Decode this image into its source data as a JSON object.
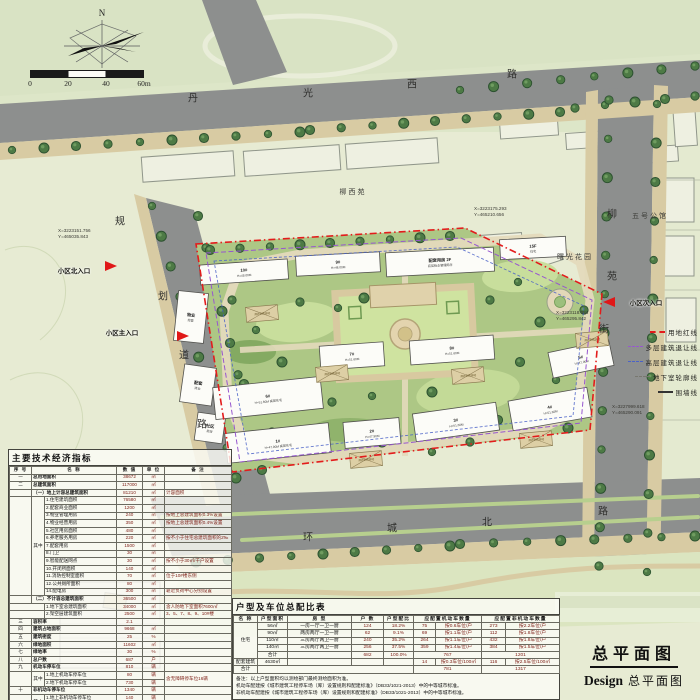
{
  "compass": {
    "north_label": "N"
  },
  "scale_bar": {
    "ticks": [
      "0",
      "20",
      "40",
      "60m"
    ]
  },
  "title_block": {
    "main": "总平面图",
    "sub_en": "Design",
    "sub_cn": "总平面图"
  },
  "legend": {
    "items": [
      {
        "label": "用地红线",
        "style": "red"
      },
      {
        "label": "多层建筑退让线",
        "style": "purple"
      },
      {
        "label": "高层建筑退让线",
        "style": "blue"
      },
      {
        "label": "地下室轮廓线",
        "style": "gray"
      },
      {
        "label": "围墙线",
        "style": "solid"
      }
    ]
  },
  "colors": {
    "boundary_red": "#e31c1c",
    "setback_purple": "#9757cf",
    "setback_blue": "#4a62c8",
    "road_gray": "#8d8f8e",
    "site_green": "#adc785",
    "value_text": "#7d1d15"
  },
  "plan": {
    "road_names": [
      {
        "name": "丹光西路",
        "chars": [
          {
            "c": "丹",
            "x": 193,
            "y": 97
          },
          {
            "c": "光",
            "x": 308,
            "y": 92
          },
          {
            "c": "西",
            "x": 412,
            "y": 83
          },
          {
            "c": "路",
            "x": 512,
            "y": 73
          }
        ]
      },
      {
        "name": "环城北路",
        "chars": [
          {
            "c": "环",
            "x": 308,
            "y": 536
          },
          {
            "c": "城",
            "x": 392,
            "y": 527
          },
          {
            "c": "北",
            "x": 487,
            "y": 521
          },
          {
            "c": "路",
            "x": 603,
            "y": 510
          }
        ]
      },
      {
        "name": "规划道路",
        "chars": [
          {
            "c": "规",
            "x": 120,
            "y": 220
          },
          {
            "c": "划",
            "x": 163,
            "y": 295
          },
          {
            "c": "道",
            "x": 184,
            "y": 354
          },
          {
            "c": "路",
            "x": 202,
            "y": 423
          }
        ]
      },
      {
        "name": "柳苑街",
        "chars": [
          {
            "c": "柳",
            "x": 612,
            "y": 213
          },
          {
            "c": "苑",
            "x": 612,
            "y": 275
          },
          {
            "c": "街",
            "x": 604,
            "y": 328
          }
        ]
      }
    ],
    "area_labels": [
      {
        "t": "柳西苑",
        "x": 353,
        "y": 192
      },
      {
        "t": "五号公馆",
        "x": 650,
        "y": 216
      },
      {
        "t": "曙光花园",
        "x": 575,
        "y": 257
      }
    ],
    "coordinates": [
      {
        "x": 58,
        "y": 228,
        "l1": "X=3223151.756",
        "l2": "Y=465035.843"
      },
      {
        "x": 474,
        "y": 206,
        "l1": "X=3223175.293",
        "l2": "Y=465210.656"
      },
      {
        "x": 556,
        "y": 310,
        "l1": "X=3223118.084",
        "l2": "Y=465295.842"
      },
      {
        "x": 612,
        "y": 404,
        "l1": "X=3227999.618",
        "l2": "Y=465290.091"
      }
    ],
    "entrances": [
      {
        "label": "小区北入口",
        "lx": 74,
        "ly": 270,
        "tx": 112,
        "ty": 266,
        "dir": "e"
      },
      {
        "label": "小区主入口",
        "lx": 122,
        "ly": 332,
        "tx": 184,
        "ty": 336,
        "dir": "e"
      },
      {
        "label": "小区次入口",
        "lx": 646,
        "ly": 302,
        "tx": 608,
        "ty": 302,
        "dir": "w"
      }
    ],
    "buildings": [
      {
        "x": 200,
        "y": 262,
        "w": 88,
        "h": 20,
        "a": -4,
        "t": "10#",
        "s": "H=48.00M"
      },
      {
        "x": 296,
        "y": 254,
        "w": 84,
        "h": 20,
        "a": -3,
        "t": "9#",
        "s": "H=48.00M"
      },
      {
        "x": 386,
        "y": 250,
        "w": 108,
        "h": 24,
        "a": -3,
        "t": "配套用房 2F",
        "s": "底层物业管理用房"
      },
      {
        "x": 500,
        "y": 238,
        "w": 66,
        "h": 20,
        "a": -3,
        "t": "15F",
        "s": "住宅"
      },
      {
        "x": 176,
        "y": 292,
        "w": 30,
        "h": 50,
        "a": 6,
        "t": "物业",
        "s": "经营"
      },
      {
        "x": 182,
        "y": 366,
        "w": 32,
        "h": 38,
        "a": 8,
        "t": "配套",
        "s": "商业"
      },
      {
        "x": 196,
        "y": 414,
        "w": 28,
        "h": 28,
        "a": 8,
        "t": "社区",
        "s": "用房"
      },
      {
        "x": 214,
        "y": 382,
        "w": 108,
        "h": 32,
        "a": -6,
        "t": "6#",
        "s": "H=51.60M 高层住宅"
      },
      {
        "x": 320,
        "y": 344,
        "w": 64,
        "h": 24,
        "a": -4,
        "t": "7#",
        "s": "H=51.60M"
      },
      {
        "x": 410,
        "y": 338,
        "w": 84,
        "h": 24,
        "a": -4,
        "t": "8#",
        "s": "H=51.60M"
      },
      {
        "x": 550,
        "y": 346,
        "w": 62,
        "h": 26,
        "a": -12,
        "t": "5#",
        "s": "H=47.90M"
      },
      {
        "x": 226,
        "y": 428,
        "w": 104,
        "h": 30,
        "a": -6,
        "t": "1#",
        "s": "H=47.90M 高层住宅"
      },
      {
        "x": 344,
        "y": 420,
        "w": 56,
        "h": 26,
        "a": -5,
        "t": "2#",
        "s": "H=47.90M"
      },
      {
        "x": 414,
        "y": 408,
        "w": 84,
        "h": 28,
        "a": -8,
        "t": "3#",
        "s": "H=51.60M"
      },
      {
        "x": 510,
        "y": 394,
        "w": 80,
        "h": 30,
        "a": -10,
        "t": "4#",
        "s": "H=51.60M"
      }
    ],
    "fire_pads": {
      "label": "消防登高场地",
      "items": [
        {
          "x": 246,
          "y": 306
        },
        {
          "x": 316,
          "y": 366
        },
        {
          "x": 452,
          "y": 368
        },
        {
          "x": 520,
          "y": 432
        },
        {
          "x": 350,
          "y": 452
        },
        {
          "x": 576,
          "y": 332
        }
      ]
    }
  },
  "econ_table": {
    "title": "主要技术经济指标",
    "cols": [
      22,
      13,
      72,
      26,
      22,
      67
    ],
    "colcls": [
      "no",
      "qz",
      "nm",
      "v",
      "u",
      "r"
    ],
    "rows": [
      [
        [
          "序 号"
        ],
        [
          "名 称",
          2
        ],
        [
          "数 值"
        ],
        [
          "单 位"
        ],
        [
          "备 注"
        ]
      ],
      [
        [
          "一"
        ],
        [
          "总用地面积",
          2,
          1,
          "nm1"
        ],
        [
          "38672"
        ],
        [
          "㎡"
        ],
        [
          ""
        ]
      ],
      [
        [
          "二"
        ],
        [
          "总建筑面积",
          2,
          1,
          "nm1"
        ],
        [
          "117000"
        ],
        [
          "㎡"
        ],
        [
          ""
        ]
      ],
      [
        [
          ""
        ],
        [
          "（一）地上计容总建筑面积",
          2,
          1,
          "secnm"
        ],
        [
          "81210"
        ],
        [
          "㎡"
        ],
        [
          "计容面积"
        ]
      ],
      [
        [
          "",
          1,
          13
        ],
        [
          "其中",
          1,
          13
        ],
        [
          "1.住宅建筑面积"
        ],
        [
          "76580"
        ],
        [
          "㎡"
        ],
        [
          ""
        ]
      ],
      [
        [
          "2.配套商业面积"
        ],
        [
          "1200"
        ],
        [
          "㎡"
        ],
        [
          ""
        ]
      ],
      [
        [
          "3.物业管理用房"
        ],
        [
          "240"
        ],
        [
          "㎡"
        ],
        [
          "按地上总建筑面积0.3%设置"
        ]
      ],
      [
        [
          "4.物业经营用房"
        ],
        [
          "350"
        ],
        [
          "㎡"
        ],
        [
          "按地上总建筑面积0.4%设置"
        ]
      ],
      [
        [
          "5.社区用房面积"
        ],
        [
          "480"
        ],
        [
          "㎡"
        ],
        [
          ""
        ]
      ],
      [
        [
          "6.养老服务用房"
        ],
        [
          "220"
        ],
        [
          "㎡"
        ],
        [
          "按不小于住宅总建筑面积的2‰"
        ]
      ],
      [
        [
          "7.配套用房"
        ],
        [
          "1500"
        ],
        [
          "㎡"
        ],
        [
          ""
        ]
      ],
      [
        [
          "8.门卫"
        ],
        [
          "30"
        ],
        [
          "㎡"
        ],
        [
          ""
        ]
      ],
      [
        [
          "9.智能配送网点"
        ],
        [
          "30"
        ],
        [
          "㎡"
        ],
        [
          "按不小于30㎡/千户设置"
        ]
      ],
      [
        [
          "10.开闭所面积"
        ],
        [
          "140"
        ],
        [
          "㎡"
        ],
        [
          ""
        ]
      ],
      [
        [
          "11.消防控制室面积"
        ],
        [
          "70"
        ],
        [
          "㎡"
        ],
        [
          "位于10#楼东侧"
        ]
      ],
      [
        [
          "12.公共厕所面积"
        ],
        [
          "80"
        ],
        [
          "㎡"
        ],
        [
          ""
        ]
      ],
      [
        [
          "14.配电房"
        ],
        [
          "300"
        ],
        [
          "㎡"
        ],
        [
          "靠近负荷中心分别设置"
        ]
      ],
      [
        [
          ""
        ],
        [
          "（二）不计容总建筑面积",
          2,
          1,
          "secnm"
        ],
        [
          "36500"
        ],
        [
          "㎡"
        ],
        [
          ""
        ]
      ],
      [
        [
          "",
          2
        ],
        [
          "1.地下室总建筑面积"
        ],
        [
          "34000"
        ],
        [
          "㎡"
        ],
        [
          "含人防地下室面积7600㎡"
        ]
      ],
      [
        [
          "",
          2
        ],
        [
          "2.架空层建筑面积"
        ],
        [
          "2500"
        ],
        [
          "㎡"
        ],
        [
          "3、5、7、8、9、10#楼"
        ]
      ],
      [
        [
          "三"
        ],
        [
          "容积率",
          2,
          1,
          "nm1"
        ],
        [
          "2.1"
        ],
        [
          ""
        ],
        [
          ""
        ]
      ],
      [
        [
          "四"
        ],
        [
          "建筑占地面积",
          2,
          1,
          "nm1"
        ],
        [
          "9668"
        ],
        [
          "㎡"
        ],
        [
          ""
        ]
      ],
      [
        [
          "五"
        ],
        [
          "建筑密度",
          2,
          1,
          "nm1"
        ],
        [
          "25"
        ],
        [
          "%"
        ],
        [
          ""
        ]
      ],
      [
        [
          "六"
        ],
        [
          "绿地面积",
          2,
          1,
          "nm1"
        ],
        [
          "11602"
        ],
        [
          "㎡"
        ],
        [
          ""
        ]
      ],
      [
        [
          "七"
        ],
        [
          "绿地率",
          2,
          1,
          "nm1"
        ],
        [
          "30"
        ],
        [
          "%"
        ],
        [
          ""
        ]
      ],
      [
        [
          "八"
        ],
        [
          "总户数",
          2,
          1,
          "nm1"
        ],
        [
          "687"
        ],
        [
          "户"
        ],
        [
          ""
        ]
      ],
      [
        [
          "九"
        ],
        [
          "机动车停车位",
          2,
          1,
          "nm1"
        ],
        [
          "810"
        ],
        [
          "辆"
        ],
        [
          ""
        ]
      ],
      [
        [
          "",
          1,
          2
        ],
        [
          "其中",
          1,
          2
        ],
        [
          "1.地上机动车停车位"
        ],
        [
          "80"
        ],
        [
          "辆"
        ],
        [
          "含无障碍停车位16辆",
          1,
          2
        ]
      ],
      [
        [
          "2.地下机动车停车位"
        ],
        [
          "730"
        ],
        [
          "辆"
        ]
      ],
      [
        [
          "十"
        ],
        [
          "非机动车停车位",
          2,
          1,
          "nm1"
        ],
        [
          "1340"
        ],
        [
          "辆"
        ],
        [
          ""
        ]
      ],
      [
        [
          "",
          1,
          2
        ],
        [
          "其中",
          1,
          2
        ],
        [
          "1.地上非机动车停车位"
        ],
        [
          "140"
        ],
        [
          "辆"
        ],
        [
          "",
          1,
          2
        ]
      ],
      [
        [
          "2.地下非机动车停车位"
        ],
        [
          "1200"
        ],
        [
          "辆"
        ]
      ]
    ]
  },
  "parking_table": {
    "title": "户型及车位总配比表",
    "cols": [
      24,
      30,
      64,
      32,
      30,
      22,
      46,
      24,
      54
    ],
    "colcls": [
      "ctr",
      "ctr",
      "ctr",
      "v",
      "v",
      "v",
      "rl",
      "v",
      "rl"
    ],
    "rows": [
      [
        [
          "名 称"
        ],
        [
          "户型面积"
        ],
        [
          "房 型"
        ],
        [
          "户 数"
        ],
        [
          "户型配比"
        ],
        [
          "应配置机动车数量",
          2
        ],
        [
          "应配置非机动车数量",
          2
        ]
      ],
      [
        [
          "住宅",
          1,
          5
        ],
        [
          "56㎡"
        ],
        [
          "一房一厅一卫一厨"
        ],
        [
          "124"
        ],
        [
          "18.2%"
        ],
        [
          "75"
        ],
        [
          "按0.6车位/户"
        ],
        [
          "273"
        ],
        [
          "按2.2车位/户"
        ]
      ],
      [
        [
          "90㎡"
        ],
        [
          "两房两厅一卫一厨"
        ],
        [
          "62"
        ],
        [
          "9.1%"
        ],
        [
          "69"
        ],
        [
          "按1.1车位/户"
        ],
        [
          "112"
        ],
        [
          "按1.8车位/户"
        ]
      ],
      [
        [
          "110㎡"
        ],
        [
          "三房两厅两卫一厨"
        ],
        [
          "240"
        ],
        [
          "35.2%"
        ],
        [
          "264"
        ],
        [
          "按1.1车位/户"
        ],
        [
          "432"
        ],
        [
          "按1.8车位/户"
        ]
      ],
      [
        [
          "140㎡"
        ],
        [
          "三房两厅两卫一厨"
        ],
        [
          "256"
        ],
        [
          "37.5%"
        ],
        [
          "359"
        ],
        [
          "按1.4车位/户"
        ],
        [
          "384"
        ],
        [
          "按1.5车位/户"
        ]
      ],
      [
        [
          "合计"
        ],
        [
          ""
        ],
        [
          "682"
        ],
        [
          "100.0%"
        ],
        [
          "767",
          2
        ],
        [
          "1201",
          2
        ]
      ],
      [
        [
          "配套建筑"
        ],
        [
          "4630㎡"
        ],
        [
          ""
        ],
        [
          ""
        ],
        [
          ""
        ],
        [
          "14"
        ],
        [
          "按0.3车位/100㎡"
        ],
        [
          "116"
        ],
        [
          "按2.5车位/100㎡"
        ]
      ],
      [
        [
          "合计"
        ],
        [
          "",
          4
        ],
        [
          "781",
          2
        ],
        [
          "1317",
          2
        ]
      ]
    ],
    "notes": [
      "备注：以上户型面积均以测绘部门最终测绘面积为准。",
      "机动车配建按《城市建筑工程停车场（库）设置规则和配建标准》（DB33/1021-2013）中的中等城市标准。",
      "非机动车配建按《城市建筑工程停车场（库）设置规则和配建标准》（DB33/1021-2013）中的中等城市标准。"
    ]
  }
}
